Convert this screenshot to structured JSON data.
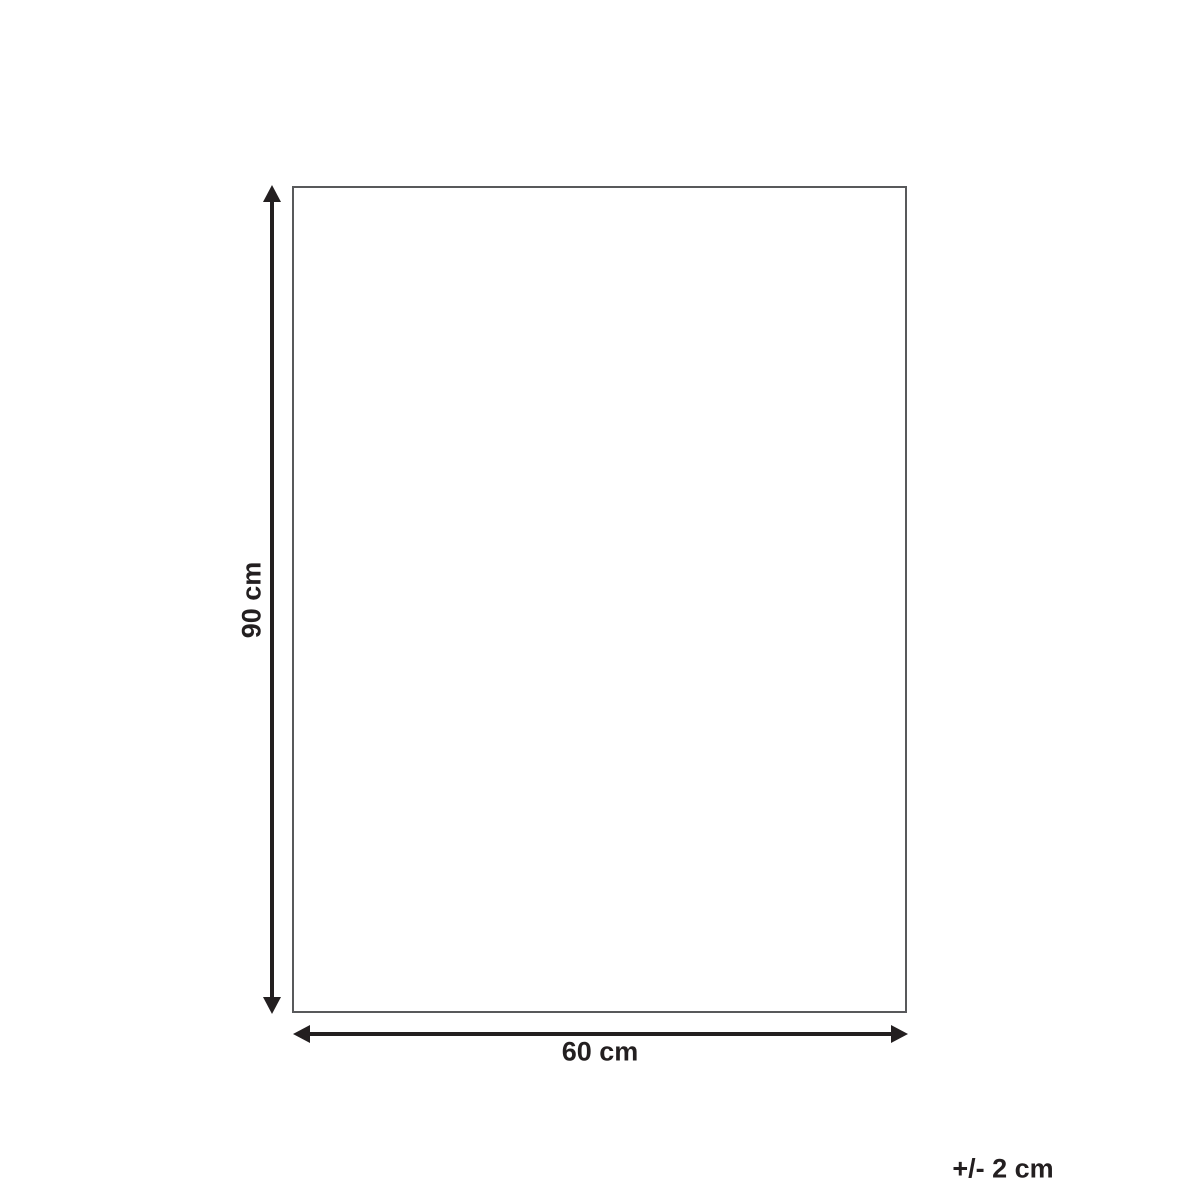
{
  "diagram": {
    "type": "product-dimension-diagram",
    "dimensions": {
      "height": {
        "label": "90 cm",
        "value": 90,
        "unit": "cm"
      },
      "width": {
        "label": "60 cm",
        "value": 60,
        "unit": "cm"
      }
    },
    "tolerance": {
      "label": "+/- 2 cm"
    }
  },
  "theme": {
    "background": "#ffffff",
    "outline_border": "#58595b",
    "arrow_color": "#231f20",
    "text_color": "#231f20"
  }
}
